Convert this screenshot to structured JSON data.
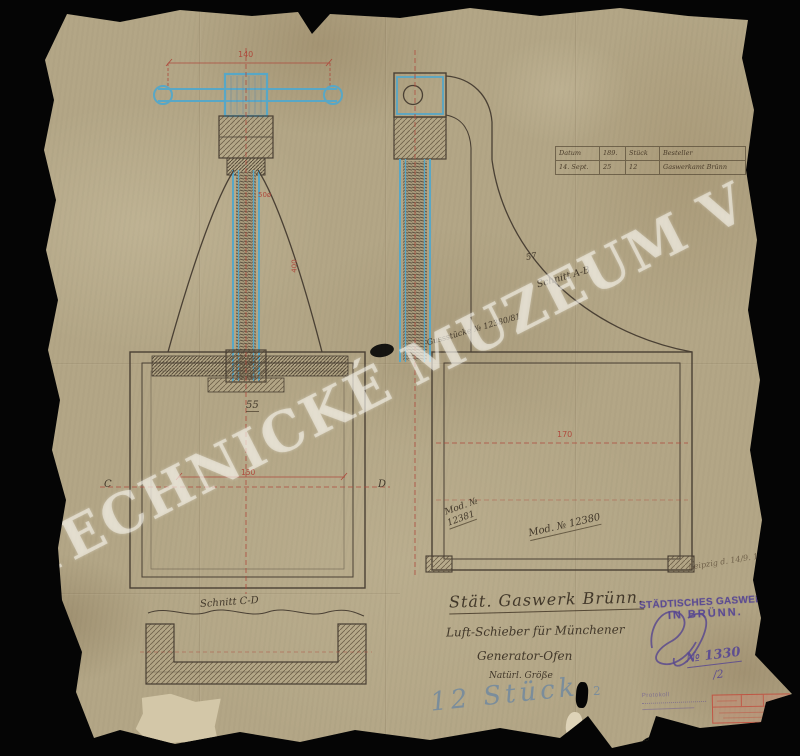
{
  "watermark": "TECHNICKÉ MUZEUM V BRNĚ",
  "title_block": {
    "company": "Stät. Gaswerk Brünn.",
    "subject_line1": "Luft-Schieber für Münchener",
    "subject_line2": "Generator-Ofen",
    "scale_note": "Natürl. Größe",
    "quantity_note": "12 Stück"
  },
  "order_table": {
    "rows": [
      [
        "Datum",
        "189.",
        "Stück",
        "Besteller"
      ],
      [
        "14. Sept.",
        "25",
        "12",
        "Gaswerkamt Brünn"
      ]
    ]
  },
  "annotations": {
    "section_ab": "Schnitt A-B",
    "section_cd": "Schnitt C-D",
    "casting_note": "Gussstücke № 12380/81",
    "model_left_line1": "Mod. №",
    "model_left_line2": "12381",
    "model_right": "Mod. № 12380",
    "place_date": "Leipzig d. 14/9. 1897",
    "letter_c": "C",
    "letter_d": "D"
  },
  "dimensions": {
    "handle_width": "140",
    "spindle_diameter": "50ø",
    "spindle_length": "400",
    "gland_width": "55",
    "box_width_left": "150",
    "box_width_right": "170",
    "flange_depth": "57"
  },
  "stamps": {
    "gaswerk_line1": "STÄDTISCHES GASWERK",
    "gaswerk_line2": "IN BRÜNN.",
    "registry_number": "№ 1330",
    "registry_sub": "/2",
    "protokoll": "Protokoll",
    "quantity_mark": "2"
  },
  "colors": {
    "paper": "#b3a686",
    "ink": "#463b2b",
    "blue_pencil": "#5fa8c8",
    "red_ink": "#ae4a3c",
    "purple_stamp": "#584a92",
    "blue_crayon": "#7e98b4"
  }
}
